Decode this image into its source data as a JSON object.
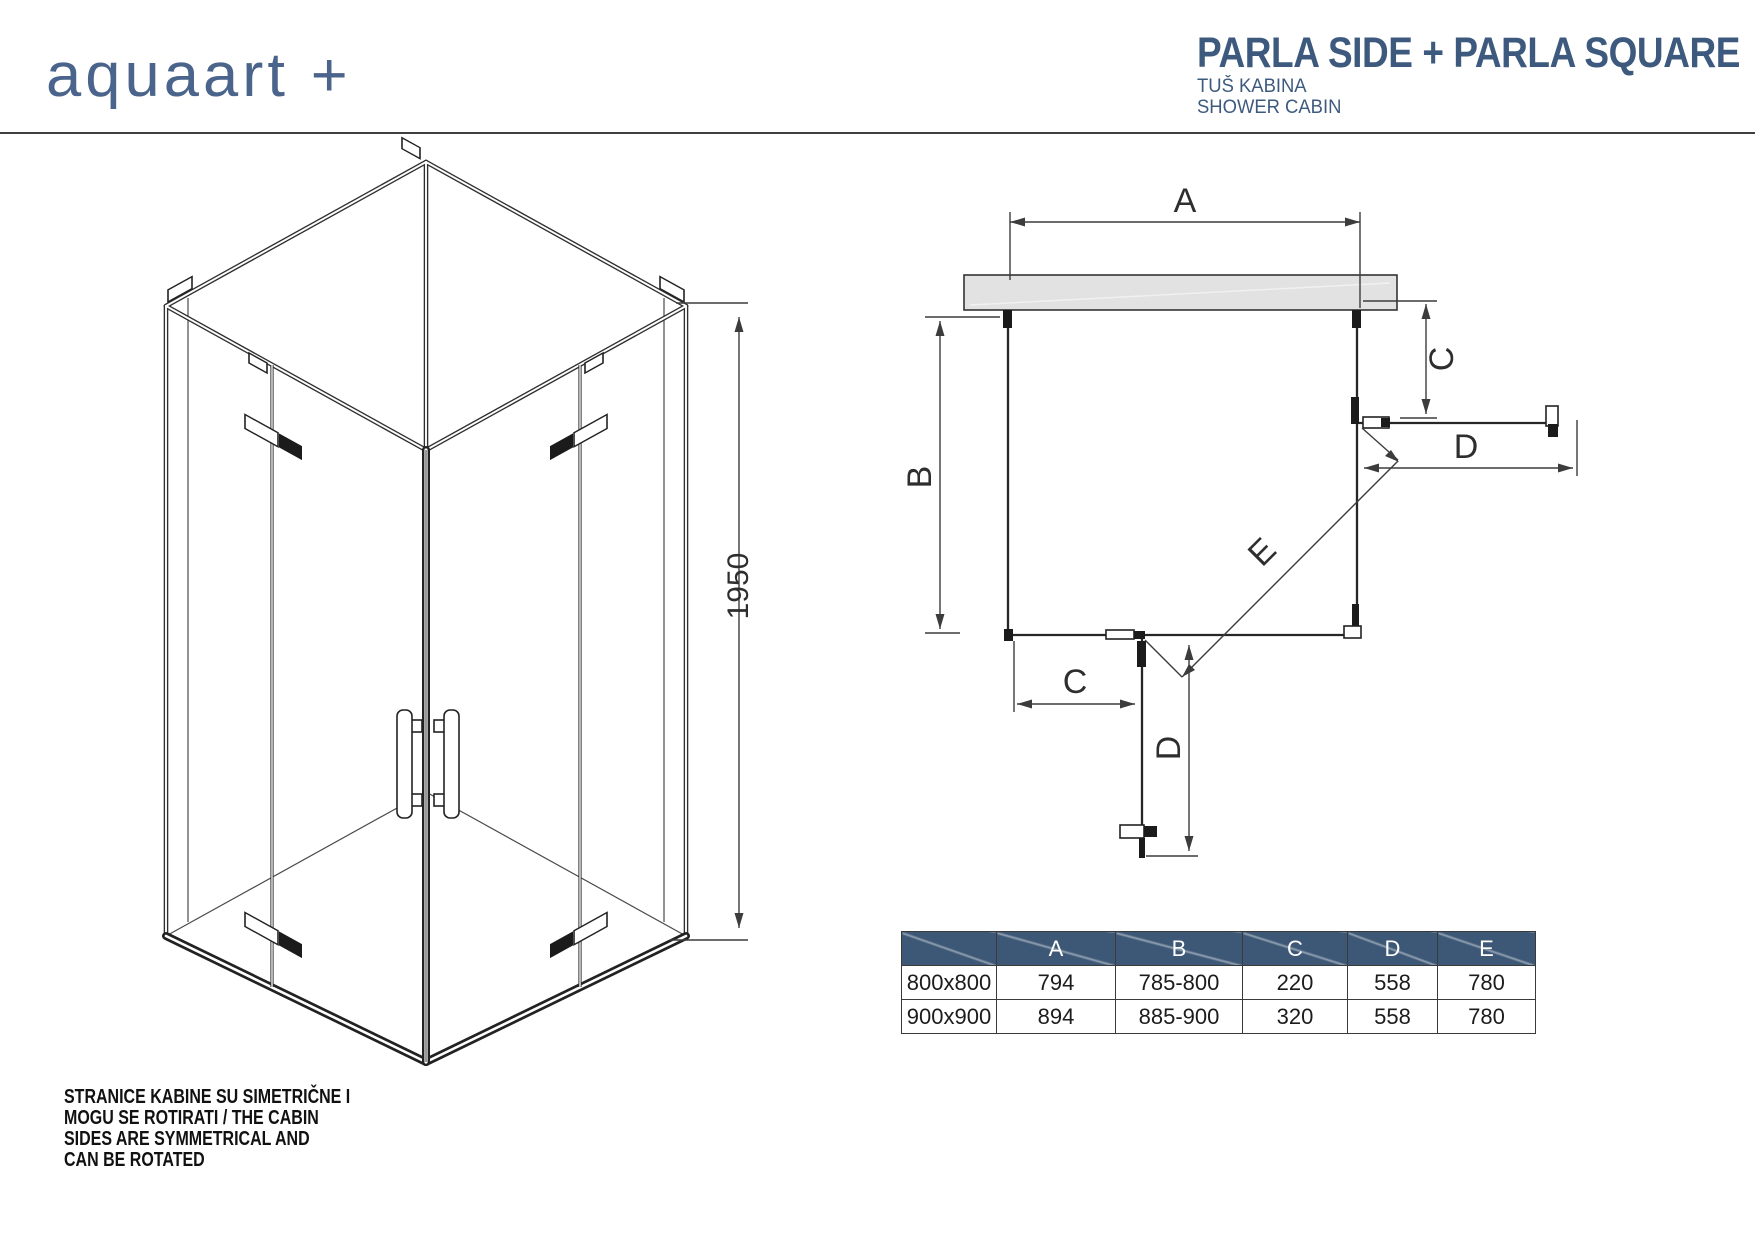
{
  "brand": {
    "logo_text": "aquaart +",
    "logo_color": "#4b648b"
  },
  "header": {
    "title": "PARLA SIDE + PARLA SQUARE",
    "subtitle_hr": "TUŠ KABINA",
    "subtitle_en": "SHOWER CABIN",
    "title_color": "#3d5a7e"
  },
  "iso_drawing": {
    "height_label": "1950"
  },
  "plan_drawing": {
    "dim_a": "A",
    "dim_b": "B",
    "dim_c": "C",
    "dim_d": "D",
    "dim_e": "E"
  },
  "table": {
    "header_bg": "#3d5876",
    "headers": [
      "",
      "A",
      "B",
      "C",
      "D",
      "E"
    ],
    "rows": [
      {
        "size": "800x800",
        "a": "794",
        "b": "785-800",
        "c": "220",
        "d": "558",
        "e": "780"
      },
      {
        "size": "900x900",
        "a": "894",
        "b": "885-900",
        "c": "320",
        "d": "558",
        "e": "780"
      }
    ]
  },
  "footnote": {
    "lines": [
      "STRANICE KABINE SU SIMETRIČNE I",
      "MOGU SE ROTIRATI / THE CABIN",
      "SIDES ARE SYMMETRICAL AND",
      "CAN BE ROTATED"
    ]
  }
}
